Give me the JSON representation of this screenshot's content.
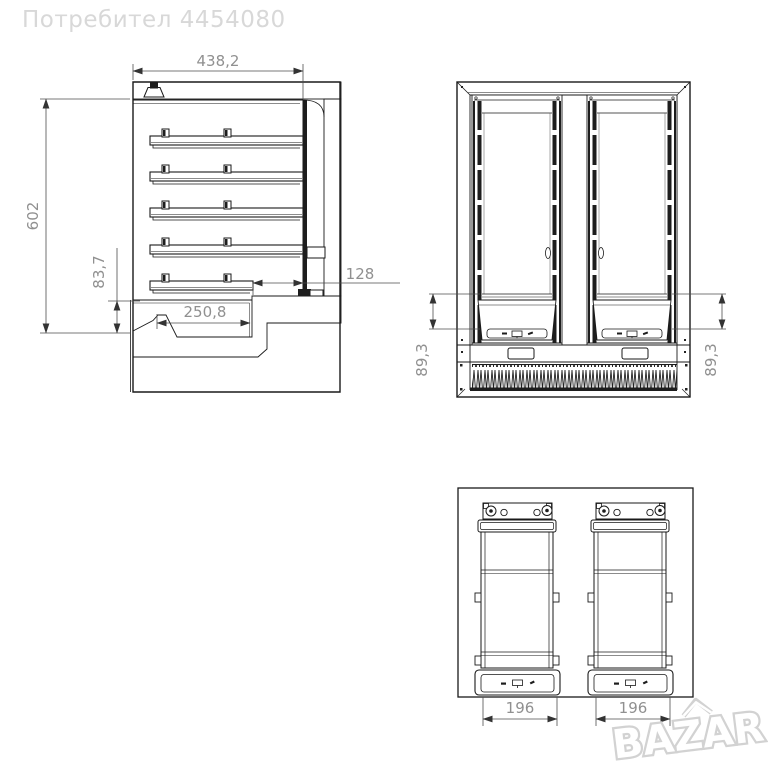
{
  "watermark": {
    "user_label": "Потребител 4454080"
  },
  "brand": {
    "logo_text": "BAZAR"
  },
  "drawing": {
    "side_view": {
      "dim_top_width": "438,2",
      "dim_left_height": "602",
      "dim_base_height": "83,7",
      "dim_floor_depth": "250,8",
      "dim_door_offset": "128"
    },
    "front_view": {
      "dim_left": "89,3",
      "dim_right": "89,3"
    },
    "back_view": {
      "dim_door_left_width": "196",
      "dim_door_right_width": "196"
    }
  },
  "colors": {
    "line": "#1a1a1a",
    "dimension_text": "#909090",
    "watermark": "#d8d8d8",
    "background": "#ffffff"
  }
}
